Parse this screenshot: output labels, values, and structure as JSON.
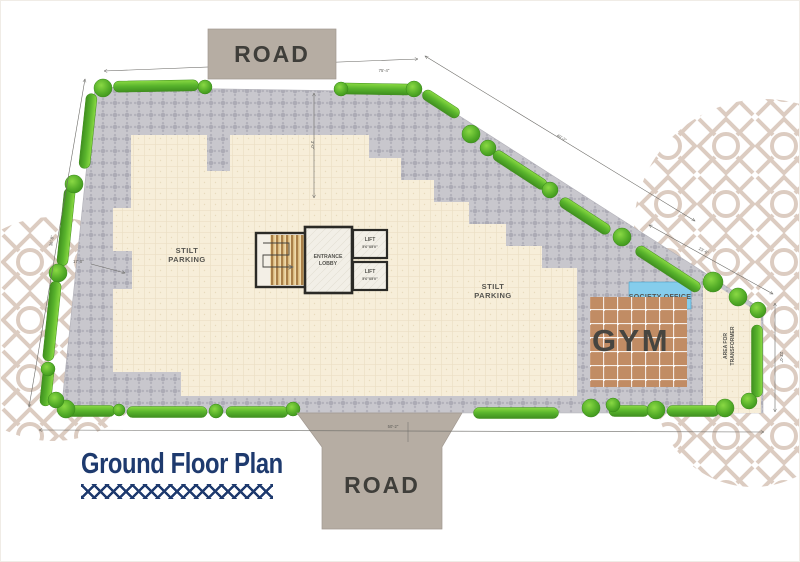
{
  "title": {
    "text": "Ground Floor Plan"
  },
  "roads": {
    "top": "ROAD",
    "bottom": "ROAD"
  },
  "areas": {
    "stilt_left": {
      "line1": "STILT",
      "line2": "PARKING"
    },
    "stilt_right": {
      "line1": "STILT",
      "line2": "PARKING"
    },
    "lobby": {
      "line1": "ENTRANCE",
      "line2": "LOBBY"
    },
    "lift_top": {
      "label": "LIFT",
      "size": "5'6\"X5'0\""
    },
    "lift_bottom": {
      "label": "LIFT",
      "size": "5'6\"X5'0\""
    },
    "society": "SOCIETY OFFICE",
    "gym": "GYM",
    "transformer": {
      "line1": "AREA FOR",
      "line2": "TRANSFORMER"
    }
  },
  "dims": {
    "top": "75'-4\"",
    "left": "36'-8\"",
    "diag_upper": "40'-2\"",
    "diag_lower": "23'-6\"",
    "right": "23'-0\"",
    "bottom": "50'-2\"",
    "setback": "3'-0\"",
    "leader": "17'-0\""
  },
  "colors": {
    "hedge_green": "#58b32c",
    "paving_gray": "#c8c7cd",
    "building_cream": "#f7eed9",
    "road_taupe": "#b6ada3",
    "gym_terracotta": "#c18c64",
    "society_blue": "#85cdec",
    "title_navy": "#1e3a6e",
    "ornament_taupe": "#d9c8bc"
  }
}
